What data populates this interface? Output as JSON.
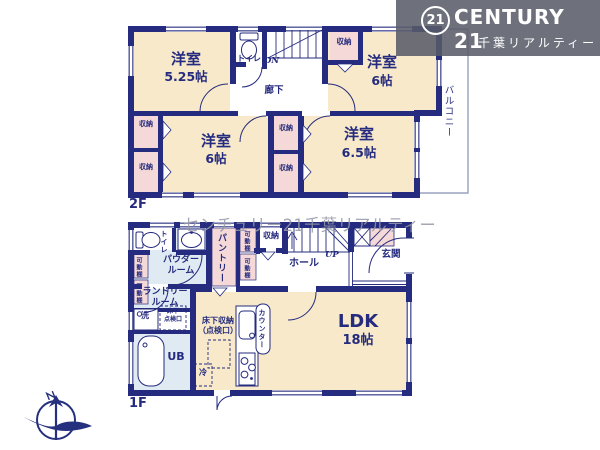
{
  "brand": {
    "badge": "21",
    "name": "CENTURY 21",
    "subtitle": "千葉リアルティー"
  },
  "watermark": "センチュリー21千葉リアルティー",
  "common": {
    "room": "洋室",
    "closet": "収納",
    "shelf": "可動棚",
    "toilet": "トイレ"
  },
  "floor2": {
    "label": "2F",
    "room1_size": "5.25帖",
    "room2_size": "6帖",
    "room3_size": "6帖",
    "room4_size": "6.5帖",
    "corridor": "廊下",
    "balcony": "バルコニー",
    "stairs": "DN"
  },
  "floor1": {
    "label": "1F",
    "ldk": "LDK",
    "ldk_size": "18帖",
    "hall": "ホール",
    "entrance": "玄関",
    "pantry": "パントリー",
    "powder1": "パウダー",
    "powder2": "ルーム",
    "laundry1": "ランドリー",
    "laundry2": "ルーム",
    "bath": "UB",
    "wash": "洗",
    "fridge": "冷",
    "counter": "カウンター",
    "underfloor_storage1": "床下収納",
    "underfloor_storage2": "（点検口）",
    "hatch1": "床下",
    "hatch2": "点検口",
    "stairs": "UP"
  }
}
